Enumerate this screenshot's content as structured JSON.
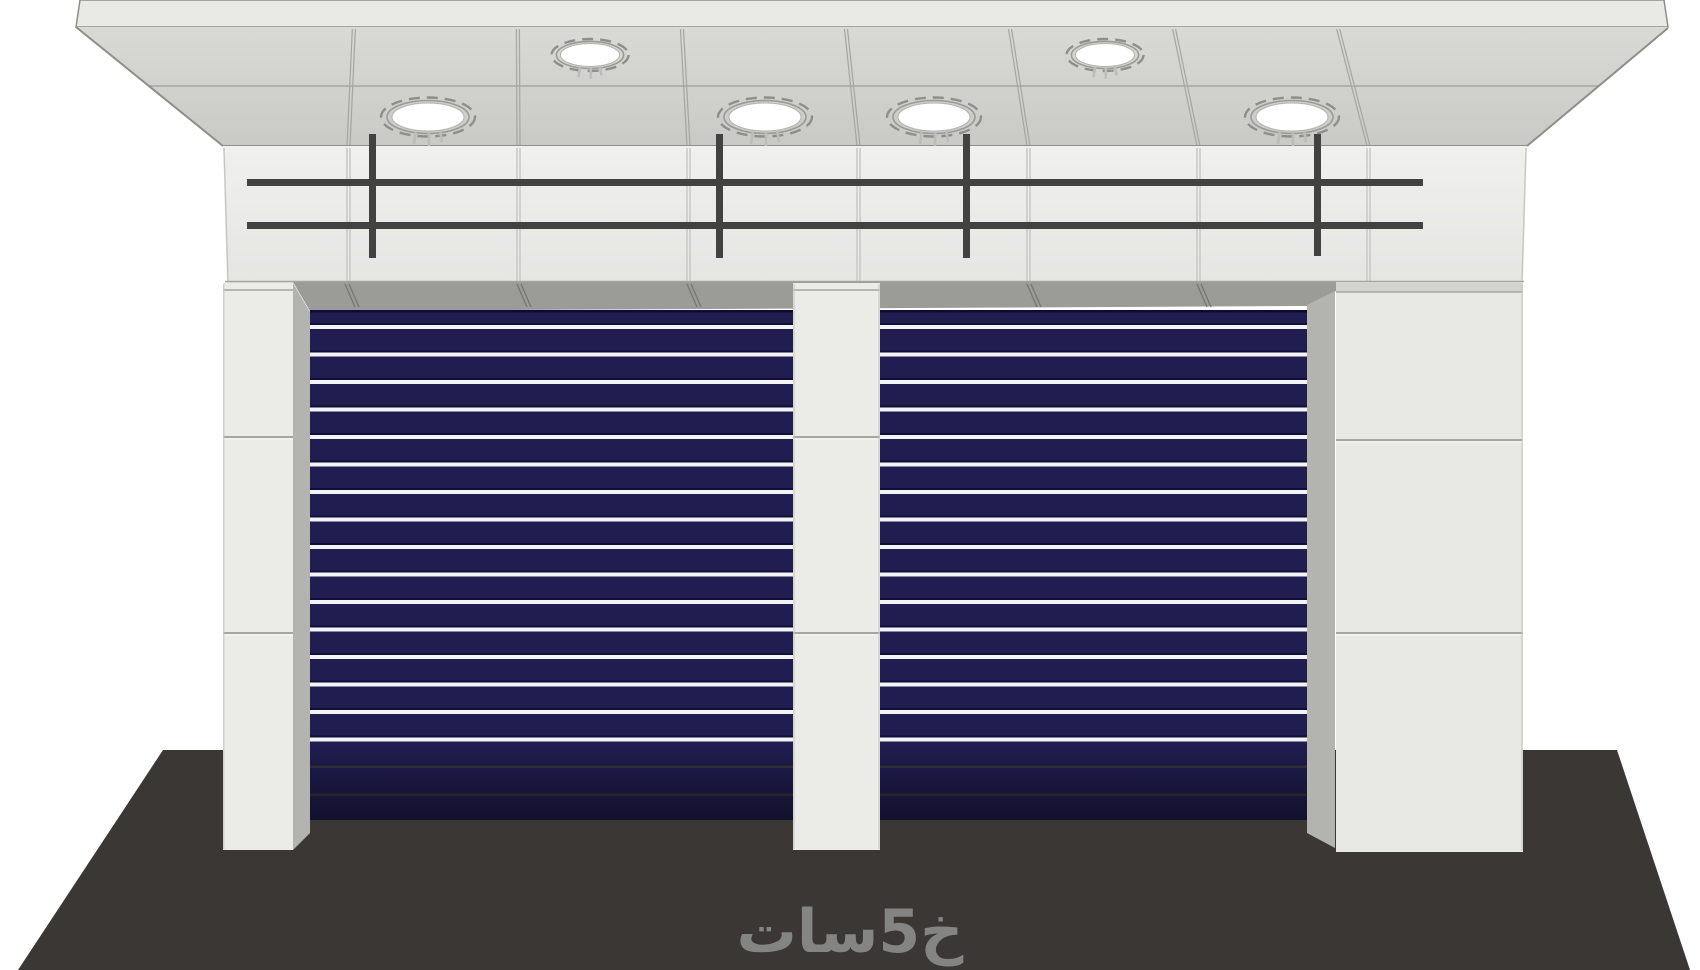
{
  "watermark": {
    "text": "خ5سات"
  },
  "scene": {
    "subject": "storefront-with-roller-shutters",
    "door_count": 2,
    "ceiling_light_count": 6,
    "white_slats_per_door": 16,
    "railing_bar_count": 2,
    "railing_post_count": 4
  },
  "palette": {
    "background": "#ffffff",
    "canopy_top": "#e9e9e6",
    "canopy_light": "#d9d9d5",
    "canopy_dark": "#c9c9c5",
    "fascia_top": "#f0f0ee",
    "fascia_bottom": "#e5e5e2",
    "seam": "#a5a5a1",
    "seam_light": "#c6c6c2",
    "edge_line": "#8e8e8a",
    "railing": "#424240",
    "soffit": "#9b9b97",
    "soffit_mark": "#787874",
    "jamb": "#b3b3af",
    "pillar": "#ebebe8",
    "wall": "#e8e8e5",
    "wall_cap": "#d3d3cf",
    "shutter_navy": "#211d51",
    "door_topline": "#0d0b33",
    "stripe_edge": "#100e3a",
    "stripe_white": "#f4f4f7",
    "stripe_deep": "#37343c",
    "ground": "#3a3734",
    "watermark": "#8b8b89",
    "light_white": "#ffffff",
    "light_ring": "#9a9a96",
    "light_dash": "#8e8e8a",
    "light_mark": "#bcbcb8"
  }
}
